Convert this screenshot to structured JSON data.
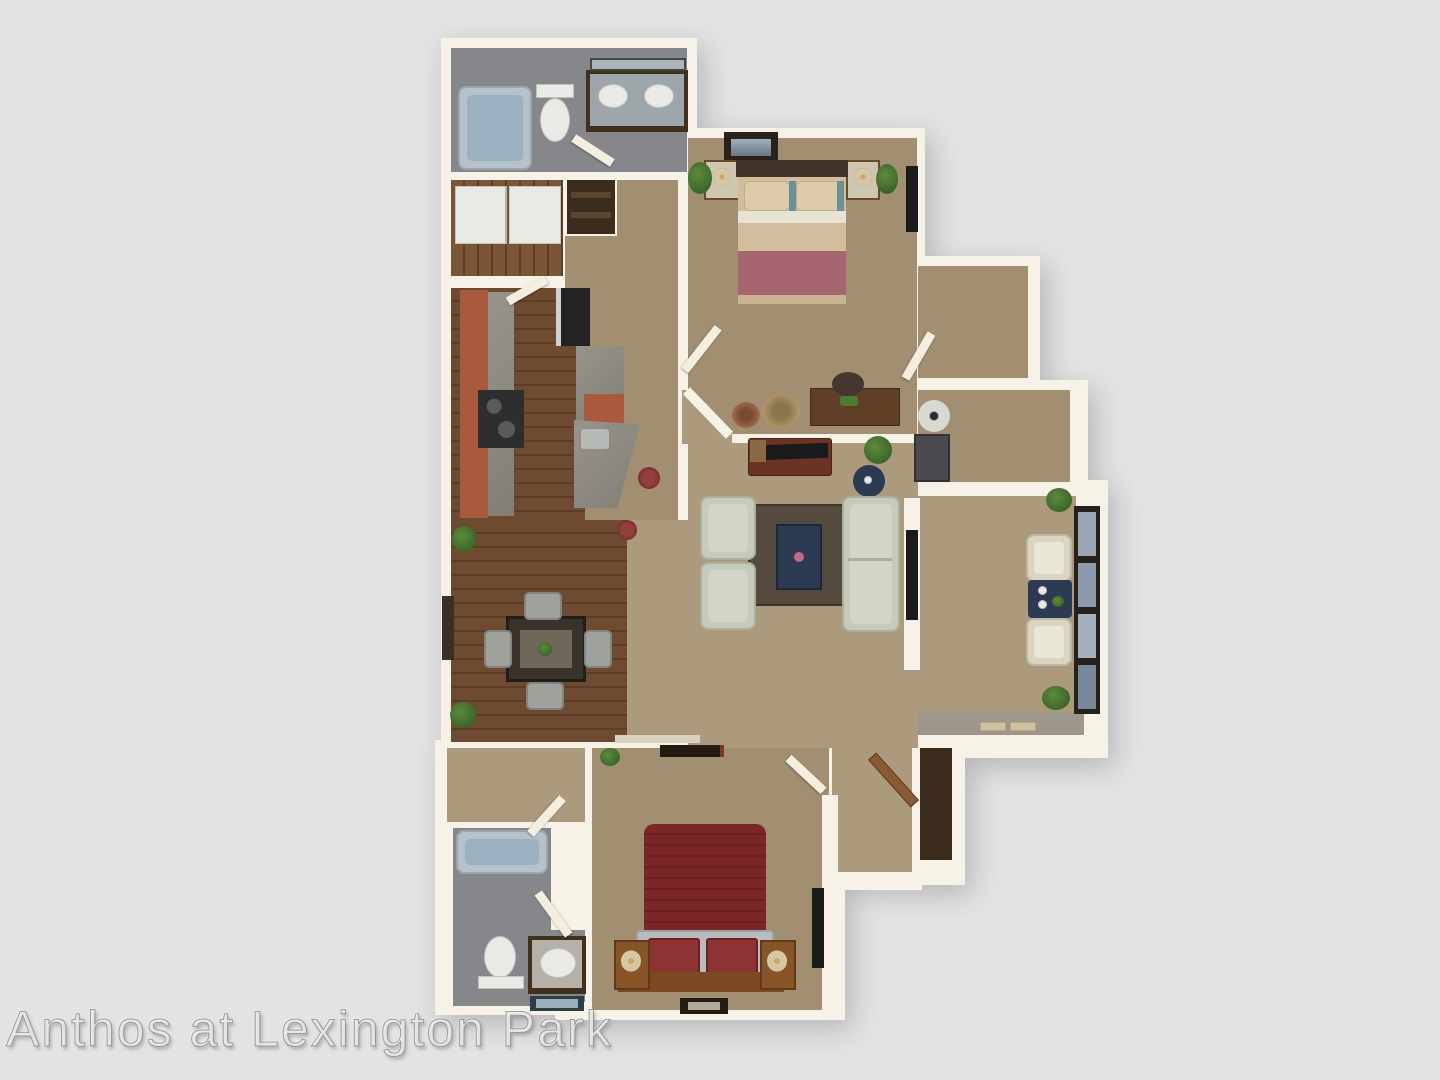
{
  "watermark": {
    "text": "Anthos at Lexington Park"
  },
  "scene": {
    "type": "3d-floorplan-rendering",
    "rooms": [
      "master-bathroom",
      "laundry-closet",
      "linen-nook",
      "hallway",
      "bedroom-2",
      "walk-in-closet",
      "storage-room",
      "kitchen",
      "dining-room",
      "living-room",
      "sunroom-patio",
      "entry-hall",
      "entry-closet",
      "walk-in-closet-2",
      "bathroom-2",
      "bedroom-1"
    ]
  },
  "palette": {
    "background": "#e3e3e4",
    "wall": "#f6f2e8",
    "carpet": "#ac9a7d",
    "carpet-dark": "#a28f72",
    "wood": "#6e4a31",
    "wood-dark": "#5d3d27",
    "laundry-wood": "#7a5636",
    "bathfloor": "#85878a",
    "tile": "#9d968c",
    "closet-dark": "#3c2c1d",
    "brick": "#a95a3c",
    "granite": "#97948c",
    "granite-dark": "#817e76",
    "stove": "#2e2e30",
    "fridge": "#232325",
    "tub-rim": "#b7c1c9",
    "tub-inner": "#9cb0bf",
    "porcelain": "#e9eae6",
    "vanity-wood": "#42301f",
    "vanity-top": "#9da6ab",
    "mirror": "#aab6bf",
    "sofa": "#c5cabb",
    "sofa-inner": "#d2d6c8",
    "cream-chair": "#dad5c3",
    "chair-gray": "#9fa19c",
    "rug": "#554a3e",
    "navy": "#2c3a54",
    "headboard-dark": "#413429",
    "mattress": "#d2bd9c",
    "pillow": "#dcccaa",
    "teal": "#6a9296",
    "white-band": "#e8e2d2",
    "blanket-mauve": "#a66570",
    "bed-red": "#7c2727",
    "bed-red-panel": "#8e3333",
    "frame-silver": "#b8bcbf",
    "wood-furn": "#8a5526",
    "desk-wood": "#5f4026",
    "console-wood": "#6b3326",
    "tv-black": "#1a1a1c",
    "lamp-cream": "#d6c7a4",
    "brass": "#c9a66a",
    "plant": "#3c6628",
    "plant-light": "#5d8a3d",
    "stool-red": "#7c2d2d",
    "door-wood": "#8a5a33",
    "door-leaf": "#f3eee0"
  }
}
